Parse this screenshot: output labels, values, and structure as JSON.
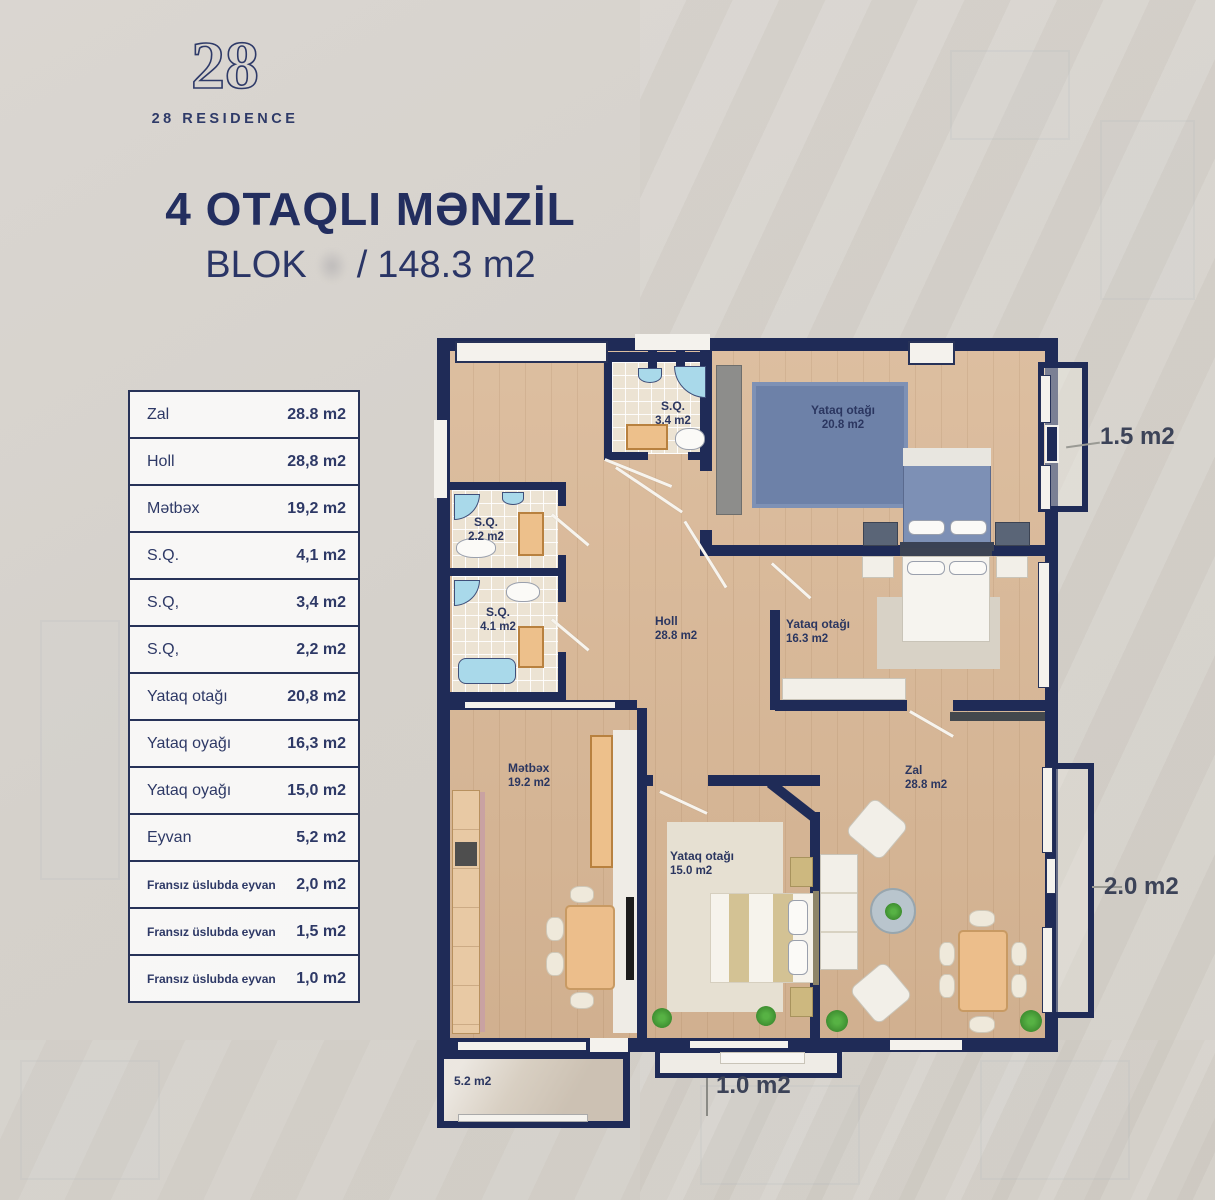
{
  "brand": {
    "logo_number": "28",
    "logo_name": "28 RESIDENCE"
  },
  "header": {
    "title": "4 OTAQLI MƏNZİL",
    "blok_label": "BLOK",
    "separator": "/",
    "total_area": "148.3 m2"
  },
  "area_table": {
    "rows": [
      {
        "label": "Zal",
        "value": "28.8 m2"
      },
      {
        "label": "Holl",
        "value": "28,8 m2"
      },
      {
        "label": "Mətbəx",
        "value": "19,2 m2"
      },
      {
        "label": "S.Q.",
        "value": "4,1 m2"
      },
      {
        "label": "S.Q,",
        "value": "3,4 m2"
      },
      {
        "label": "S.Q,",
        "value": "2,2 m2"
      },
      {
        "label": "Yataq otağı",
        "value": "20,8 m2"
      },
      {
        "label": "Yataq oyağı",
        "value": "16,3 m2"
      },
      {
        "label": "Yataq oyağı",
        "value": "15,0 m2"
      },
      {
        "label": "Eyvan",
        "value": "5,2 m2"
      },
      {
        "label": "Fransız üslubda eyvan",
        "value": "2,0 m2"
      },
      {
        "label": "Fransız üslubda eyvan",
        "value": "1,5 m2"
      },
      {
        "label": "Fransız üslubda eyvan",
        "value": "1,0 m2"
      }
    ]
  },
  "plan": {
    "rooms": {
      "sq34": {
        "name": "S.Q.",
        "area": "3.4 m2"
      },
      "sq22": {
        "name": "S.Q.",
        "area": "2.2 m2"
      },
      "sq41": {
        "name": "S.Q.",
        "area": "4.1 m2"
      },
      "bedroom20": {
        "name": "Yataq otağı",
        "area": "20.8 m2"
      },
      "holl": {
        "name": "Holl",
        "area": "28.8 m2"
      },
      "bedroom16": {
        "name": "Yataq otağı",
        "area": "16.3 m2"
      },
      "kitchen": {
        "name": "Mətbəx",
        "area": "19.2 m2"
      },
      "bedroom15": {
        "name": "Yataq otağı",
        "area": "15.0 m2"
      },
      "zal": {
        "name": "Zal",
        "area": "28.8 m2"
      }
    },
    "balconies": {
      "eyvan": "5.2 m2",
      "french_bottom": "1.0 m2",
      "french_top_right": "1.5 m2",
      "french_right": "2.0 m2"
    }
  },
  "colors": {
    "accent_navy": "#243161",
    "wall_navy": "#1f2b57",
    "wood_floor": "#d9b795",
    "bath_tile": "#ece3d3",
    "rug_blue": "#6d81a8",
    "washer_orange": "#edc08b",
    "bath_blue": "#a9d9ea"
  }
}
